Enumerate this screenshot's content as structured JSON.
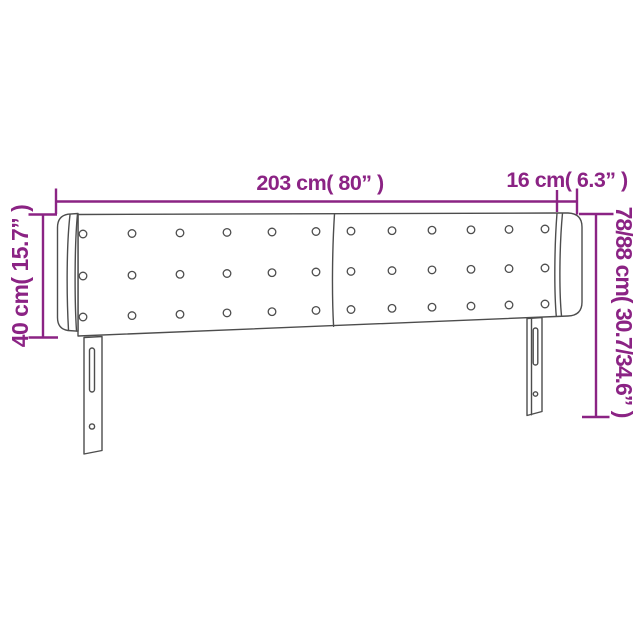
{
  "page": {
    "background": "#FFFFFF",
    "description": "Headboard dimension diagram"
  },
  "colors": {
    "dimension_accent": "#8B2384",
    "drawing_outline": "#4D4D4D"
  },
  "dimensions": {
    "total_width": {
      "cm": "203",
      "inches": "80",
      "label": "203 cm( 80” )"
    },
    "side_panel_width": {
      "cm": "16",
      "inches": "6.3",
      "label": "16 cm( 6.3” )"
    },
    "panel_height": {
      "cm": "40",
      "inches": "15.7",
      "label": "40 cm( 15.7” )"
    },
    "total_height": {
      "cm": "78/88",
      "inches": "30.7/34.6",
      "label": "78/88 cm( 30.7/34.6” )"
    }
  },
  "figure": {
    "subject": "tufted headboard with side wings and two legs",
    "button_rows": 3,
    "button_columns": 12,
    "legs": 2
  }
}
